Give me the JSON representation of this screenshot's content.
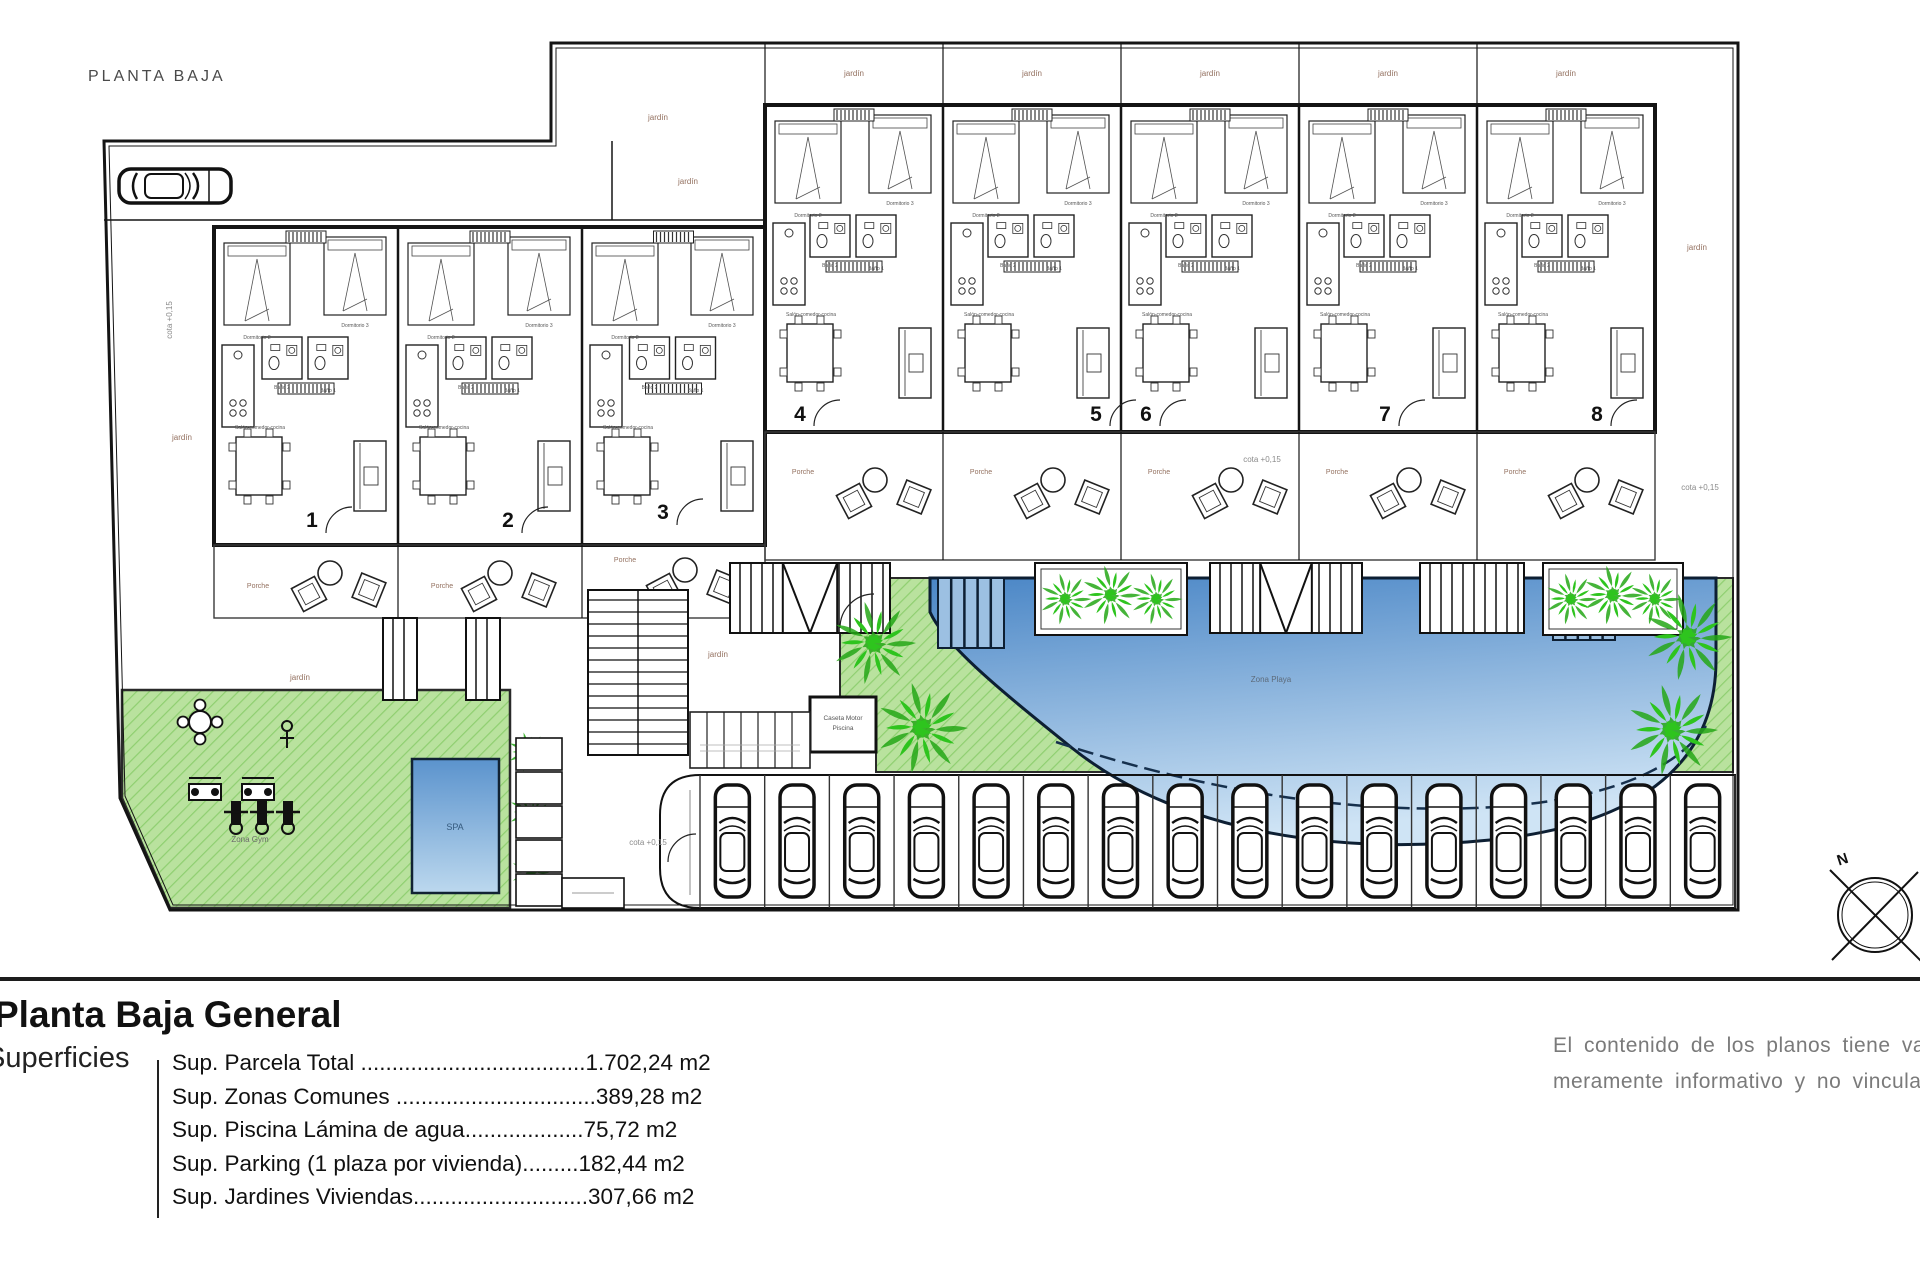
{
  "plan": {
    "title": "PLANTA BAJA",
    "labels": {
      "jardin": "jardín",
      "porche": "Porche",
      "cota": "cota +0,15",
      "zona_gym": "Zona Gym",
      "spa": "SPA",
      "zona_playa": "Zona Playa",
      "piscina": "Piscina",
      "caseta_line1": "Caseta Motor",
      "caseta_line2": "Piscina",
      "north": "N"
    },
    "room_labels": {
      "dorm1": "Dormitorio 1",
      "dorm2": "Dormitorio 2",
      "dorm3": "Dormitorio 3",
      "bath1": "Baño 1",
      "bath2": "Baño 2",
      "salon": "Salón-comedor-cocina"
    },
    "units_left": [
      "1",
      "2",
      "3"
    ],
    "units_right": [
      "4",
      "5",
      "6",
      "7",
      "8"
    ],
    "parking_spaces": 16,
    "colors": {
      "lawn": "#b9e29e",
      "lawn_stripe": "#8fcf70",
      "palm": "#2ec41e",
      "palm_dark": "#24a716",
      "pool_deep": "#4a86c6",
      "pool_shallow": "#cfe4f5",
      "pool_edge": "#0d1f33",
      "wall": "#141414",
      "thin": "#3a3a3a",
      "gray_label": "#8a8a8a",
      "area_label": "#93705f"
    }
  },
  "legend": {
    "title": "Planta Baja General",
    "section_label": "Superficies",
    "rows": [
      "Sup. Parcela Total ....................................1.702,24 m2",
      "Sup. Zonas Comunes ................................389,28 m2",
      "Sup. Piscina Lámina de agua...................75,72 m2",
      "Sup. Parking (1 plaza por vivienda).........182,44 m2",
      "Sup. Jardines Viviendas............................307,66 m2"
    ]
  },
  "disclaimer": {
    "line1": "El contenido de los planos tiene valo",
    "line2": "meramente informativo y no vinculan"
  }
}
